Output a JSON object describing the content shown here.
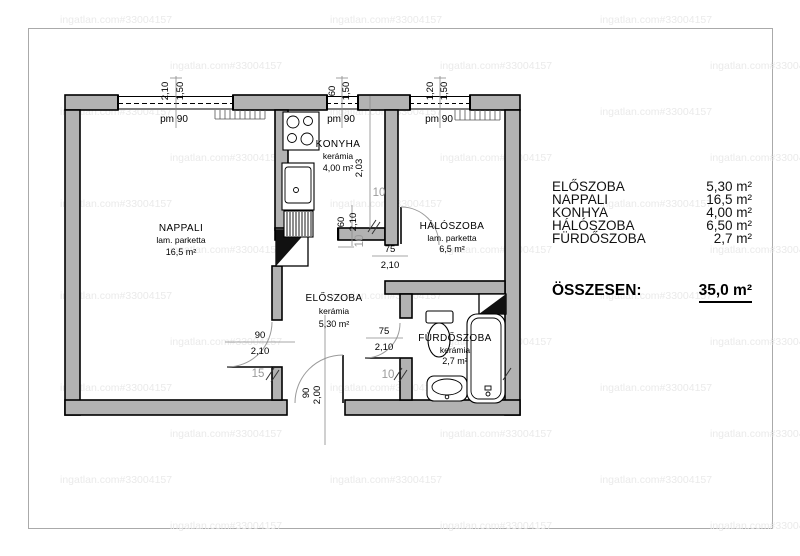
{
  "watermark": {
    "text": "ingatlan.com#33004157"
  },
  "rooms": {
    "nappali": {
      "name": "NAPPALI",
      "floor": "lam. parketta",
      "area": "16,5 m²"
    },
    "konyha": {
      "name": "KONYHA",
      "floor": "kerámia",
      "area": "4,00 m²"
    },
    "haloszoba": {
      "name": "HÁLÓSZOBA",
      "floor": "lam. parketta",
      "area": "6,5 m²"
    },
    "eloszoba": {
      "name": "ELŐSZOBA",
      "floor": "kerámia",
      "area": "5,30 m²"
    },
    "furdoszoba": {
      "name": "FÜRDŐSZOBA",
      "floor": "kerámia",
      "area": "2,7 m²"
    }
  },
  "windows": [
    {
      "w": "2,10",
      "h": "1,50",
      "pm": "pm 90"
    },
    {
      "w": "60",
      "h": "1,50",
      "pm": "pm 90"
    },
    {
      "w": "1,20",
      "h": "1,50",
      "pm": "pm 90"
    }
  ],
  "doors": {
    "nappali": {
      "w": "90",
      "h": "2,10"
    },
    "haloszoba": {
      "w": "75",
      "h": "2,10"
    },
    "furdoszoba": {
      "w": "75",
      "h": "2,10"
    },
    "bejarat": {
      "w": "90",
      "h": "2,00"
    },
    "konyha": {
      "w": "60",
      "h": "2,10"
    }
  },
  "dims": {
    "konyha_depth": "2,03",
    "t10": "10",
    "t15": "15"
  },
  "legend": {
    "rows": [
      {
        "label": "ELŐSZOBA",
        "value": "5,30 m²"
      },
      {
        "label": "NAPPALI",
        "value": "16,5 m²"
      },
      {
        "label": "KONHYA",
        "value": "4,00 m²"
      },
      {
        "label": "HÁLÓSZOBA",
        "value": "6,50 m²"
      },
      {
        "label": "FÜRDŐSZOBA",
        "value": "2,7 m²"
      }
    ],
    "total_label": "ÖSSZESEN:",
    "total_value": "35,0 m²"
  }
}
